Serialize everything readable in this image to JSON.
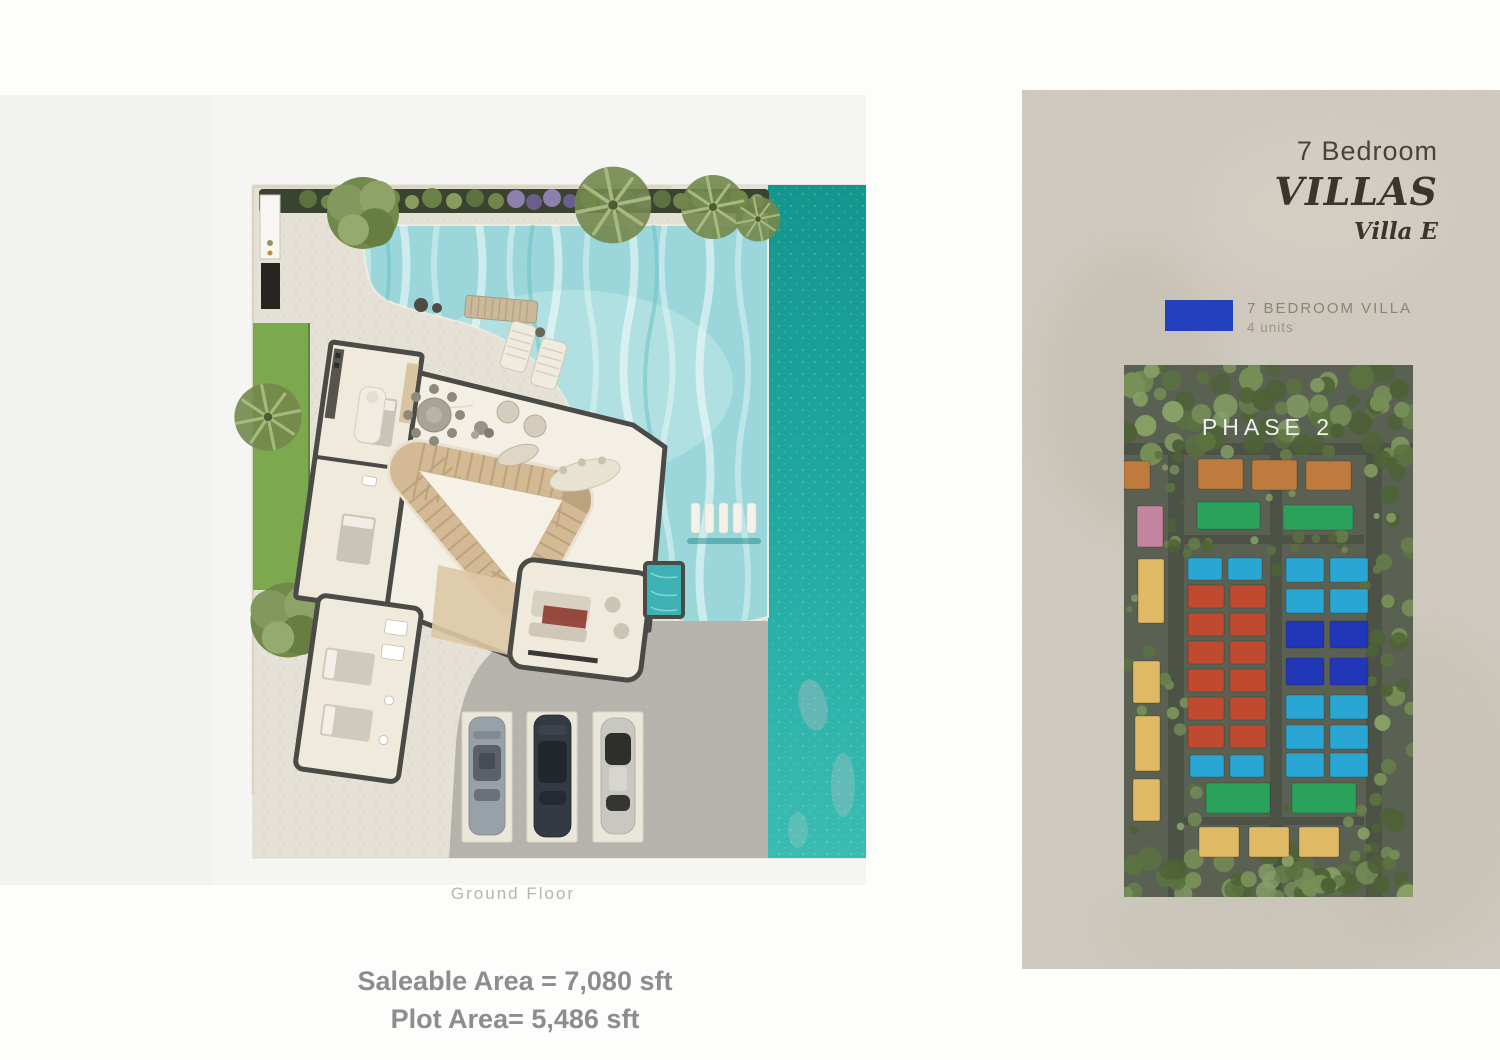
{
  "title": {
    "line1": "7 Bedroom",
    "line2": "VILLAS",
    "line3": "Villa E"
  },
  "legend": {
    "label": "7 BEDROOM VILLA",
    "sublabel": "4 units"
  },
  "site_map": {
    "phase_label": "PHASE 2",
    "blocks": [
      {
        "x": 0,
        "y": 96,
        "w": 26,
        "h": 28,
        "c": "villa_orange"
      },
      {
        "x": 74,
        "y": 94,
        "w": 45,
        "h": 30,
        "c": "villa_orange"
      },
      {
        "x": 128,
        "y": 95,
        "w": 45,
        "h": 30,
        "c": "villa_orange"
      },
      {
        "x": 182,
        "y": 96,
        "w": 45,
        "h": 29,
        "c": "villa_orange"
      },
      {
        "x": 73,
        "y": 137,
        "w": 63,
        "h": 27,
        "c": "villa_green"
      },
      {
        "x": 159,
        "y": 140,
        "w": 70,
        "h": 25,
        "c": "villa_green"
      },
      {
        "x": 13,
        "y": 141,
        "w": 26,
        "h": 41,
        "c": "villa_pink"
      },
      {
        "x": 14,
        "y": 194,
        "w": 26,
        "h": 64,
        "c": "villa_yellow"
      },
      {
        "x": 9,
        "y": 296,
        "w": 27,
        "h": 42,
        "c": "villa_yellow"
      },
      {
        "x": 11,
        "y": 351,
        "w": 25,
        "h": 55,
        "c": "villa_yellow"
      },
      {
        "x": 9,
        "y": 414,
        "w": 27,
        "h": 42,
        "c": "villa_yellow"
      },
      {
        "x": 64,
        "y": 193,
        "w": 34,
        "h": 22,
        "c": "villa_cyan"
      },
      {
        "x": 104,
        "y": 193,
        "w": 34,
        "h": 22,
        "c": "villa_cyan"
      },
      {
        "x": 66,
        "y": 390,
        "w": 34,
        "h": 22,
        "c": "villa_cyan"
      },
      {
        "x": 106,
        "y": 390,
        "w": 34,
        "h": 22,
        "c": "villa_cyan"
      },
      {
        "x": 64,
        "y": 220,
        "w": 36,
        "h": 23,
        "c": "villa_red"
      },
      {
        "x": 106,
        "y": 220,
        "w": 36,
        "h": 23,
        "c": "villa_red"
      },
      {
        "x": 64,
        "y": 248,
        "w": 36,
        "h": 23,
        "c": "villa_red"
      },
      {
        "x": 106,
        "y": 248,
        "w": 36,
        "h": 23,
        "c": "villa_red"
      },
      {
        "x": 64,
        "y": 276,
        "w": 36,
        "h": 23,
        "c": "villa_red"
      },
      {
        "x": 106,
        "y": 276,
        "w": 36,
        "h": 23,
        "c": "villa_red"
      },
      {
        "x": 64,
        "y": 304,
        "w": 36,
        "h": 23,
        "c": "villa_red"
      },
      {
        "x": 106,
        "y": 304,
        "w": 36,
        "h": 23,
        "c": "villa_red"
      },
      {
        "x": 64,
        "y": 332,
        "w": 36,
        "h": 23,
        "c": "villa_red"
      },
      {
        "x": 106,
        "y": 332,
        "w": 36,
        "h": 23,
        "c": "villa_red"
      },
      {
        "x": 64,
        "y": 360,
        "w": 36,
        "h": 23,
        "c": "villa_red"
      },
      {
        "x": 106,
        "y": 360,
        "w": 36,
        "h": 23,
        "c": "villa_red"
      },
      {
        "x": 162,
        "y": 193,
        "w": 38,
        "h": 24,
        "c": "villa_cyan"
      },
      {
        "x": 206,
        "y": 193,
        "w": 38,
        "h": 24,
        "c": "villa_cyan"
      },
      {
        "x": 162,
        "y": 224,
        "w": 38,
        "h": 24,
        "c": "villa_cyan"
      },
      {
        "x": 206,
        "y": 224,
        "w": 38,
        "h": 24,
        "c": "villa_cyan"
      },
      {
        "x": 162,
        "y": 256,
        "w": 38,
        "h": 27,
        "c": "villa_royal"
      },
      {
        "x": 206,
        "y": 256,
        "w": 38,
        "h": 27,
        "c": "villa_royal"
      },
      {
        "x": 162,
        "y": 293,
        "w": 38,
        "h": 27,
        "c": "villa_royal"
      },
      {
        "x": 206,
        "y": 293,
        "w": 38,
        "h": 27,
        "c": "villa_royal"
      },
      {
        "x": 162,
        "y": 330,
        "w": 38,
        "h": 24,
        "c": "villa_cyan"
      },
      {
        "x": 206,
        "y": 330,
        "w": 38,
        "h": 24,
        "c": "villa_cyan"
      },
      {
        "x": 162,
        "y": 360,
        "w": 38,
        "h": 24,
        "c": "villa_cyan"
      },
      {
        "x": 206,
        "y": 360,
        "w": 38,
        "h": 24,
        "c": "villa_cyan"
      },
      {
        "x": 162,
        "y": 388,
        "w": 38,
        "h": 24,
        "c": "villa_cyan"
      },
      {
        "x": 206,
        "y": 388,
        "w": 38,
        "h": 24,
        "c": "villa_cyan"
      },
      {
        "x": 82,
        "y": 418,
        "w": 64,
        "h": 30,
        "c": "villa_green"
      },
      {
        "x": 168,
        "y": 418,
        "w": 64,
        "h": 30,
        "c": "villa_green"
      },
      {
        "x": 75,
        "y": 462,
        "w": 40,
        "h": 30,
        "c": "villa_yellow"
      },
      {
        "x": 125,
        "y": 462,
        "w": 40,
        "h": 30,
        "c": "villa_yellow"
      },
      {
        "x": 175,
        "y": 462,
        "w": 40,
        "h": 30,
        "c": "villa_yellow"
      }
    ]
  },
  "floor_plan": {
    "caption": "Ground Floor",
    "saleable": "Saleable Area = 7,080 sft",
    "plot": "Plot Area= 5,486 sft"
  },
  "palette": {
    "legend_blue": "#2341bc",
    "stone_base": "#d4cec3",
    "title_text": "#39352f",
    "caption_text": "#b7b5b2",
    "areas_text": "#8d8d8d",
    "sea": "#1ba39c",
    "pool": "#9bd7da",
    "grass": "#7ca94e",
    "deck": "#e6e1d7",
    "wall": "#4a4a46",
    "floor": "#f0eadd",
    "stair_tan": "#d3ba95",
    "driveway": "#b6b3ad",
    "hedge": "#39432f",
    "map_bg": "#5a6153",
    "villa_orange": "#bf7a3e",
    "villa_green": "#2ba25c",
    "villa_pink": "#c2849f",
    "villa_yellow": "#e0b964",
    "villa_red": "#bf4a30",
    "villa_cyan": "#2aa6d4",
    "villa_royal": "#2236b8",
    "phase_text": "#f1f2ec"
  }
}
